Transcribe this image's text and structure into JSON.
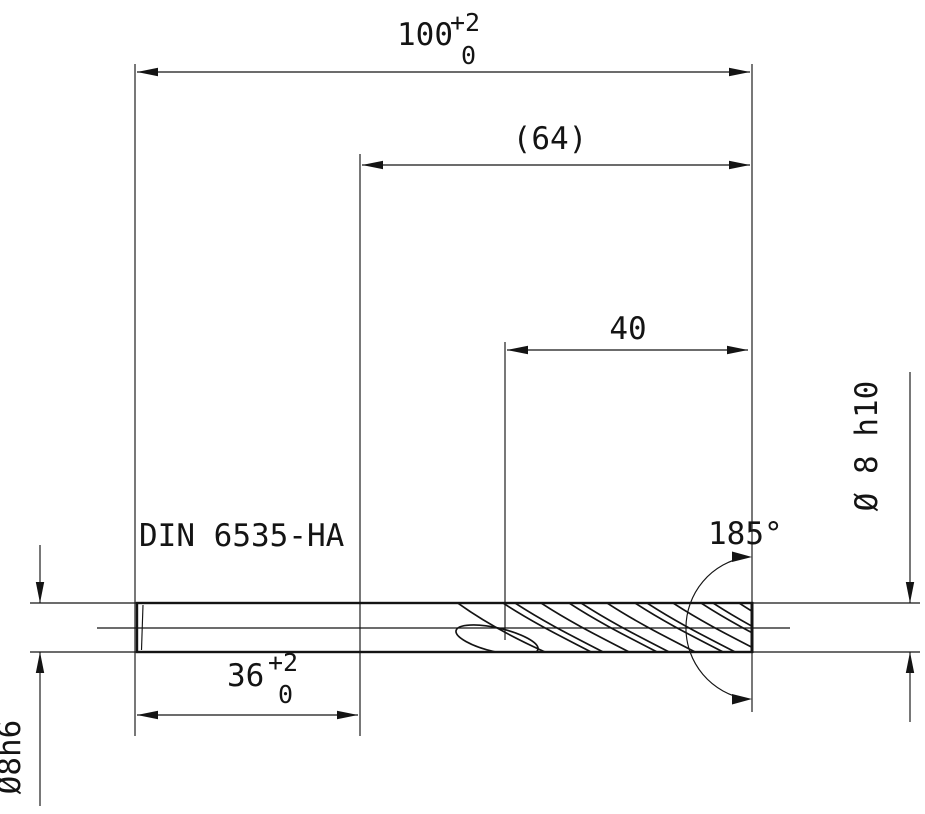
{
  "drawing": {
    "labels": {
      "standard": "DIN 6535-HA"
    },
    "dims": {
      "overall_length": {
        "value": "100",
        "tol_upper": "+2",
        "tol_lower": "0"
      },
      "reference_length": {
        "value": "(64)"
      },
      "flute_length": {
        "value": "40"
      },
      "shank_length": {
        "value": "36",
        "tol_upper": "+2",
        "tol_lower": "0"
      },
      "cutting_diameter": {
        "value": "Ø 8 h10"
      },
      "shank_diameter": {
        "value": "Ø8h6"
      },
      "point_angle": {
        "value": "185°"
      }
    },
    "colors": {
      "ink": "#141414",
      "paper": "#ffffff"
    }
  }
}
